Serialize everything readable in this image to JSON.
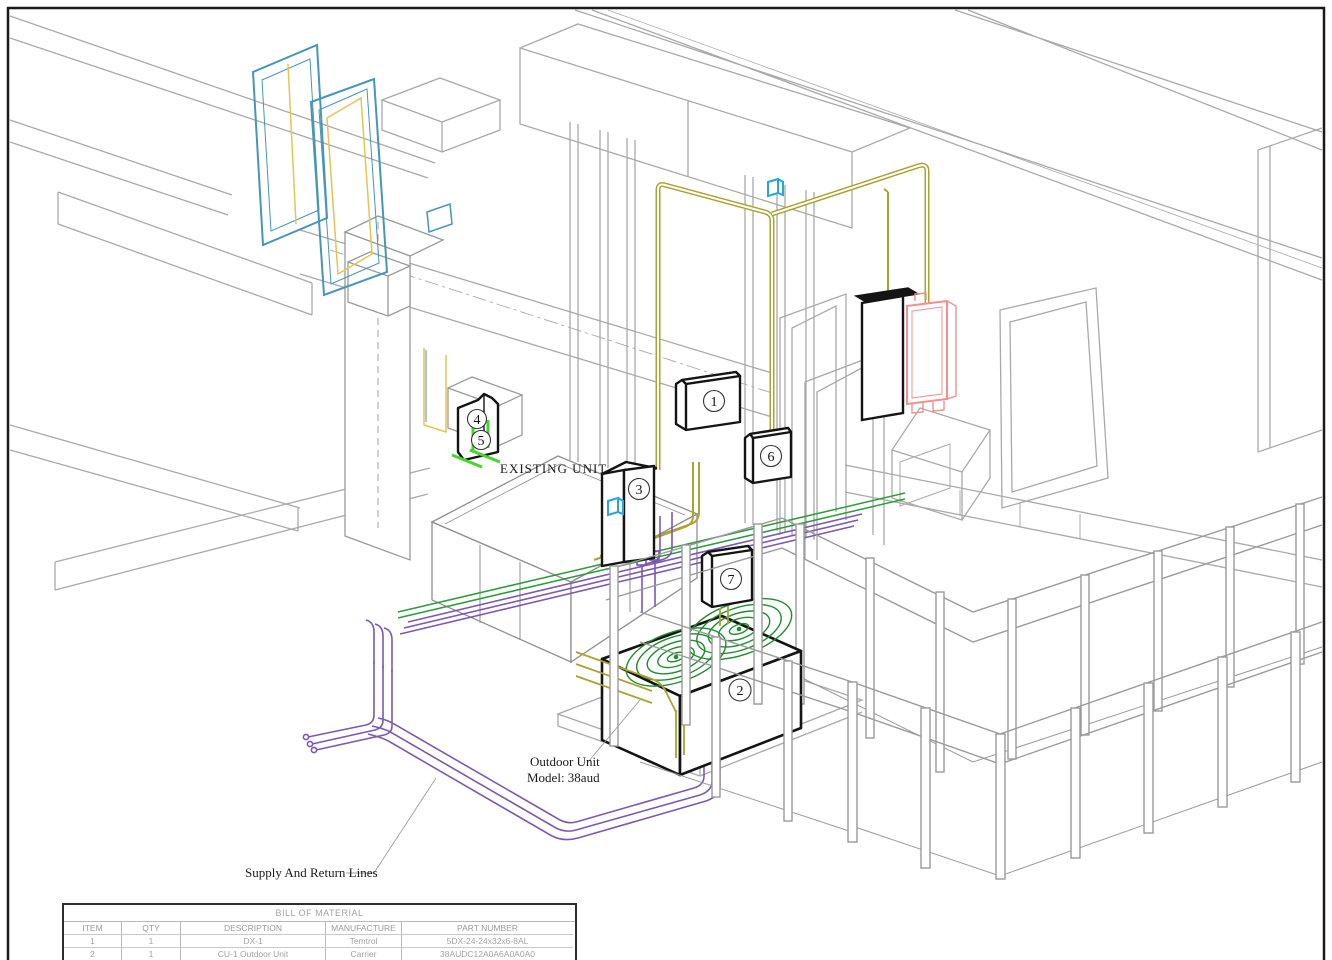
{
  "drawing": {
    "type": "isometric HVAC installation drawing",
    "annotations": {
      "existing_unit": "EXISTING UNIT",
      "outdoor_unit_line1": "Outdoor Unit",
      "outdoor_unit_line2": "Model: 38aud",
      "supply_return": "Supply And Return Lines"
    },
    "callouts": [
      {
        "number": "1"
      },
      {
        "number": "2"
      },
      {
        "number": "3"
      },
      {
        "number": "4"
      },
      {
        "number": "5"
      },
      {
        "number": "6"
      },
      {
        "number": "7"
      }
    ],
    "colors": {
      "structure_gray": "#a9a9a9",
      "heavy_black": "#141414",
      "teal_frame": "#4596b8",
      "yellow_frame": "#e6c44f",
      "conduit_olive": "#aaa32e",
      "pipe_purple": "#7e57b2",
      "pipe_green": "#2e9b3a",
      "mark_bright_green": "#44d62c",
      "fan_green": "#1f8c2f",
      "panel_red": "#f09090",
      "junction_cyan": "#25a6e0"
    }
  },
  "bom": {
    "title": "BILL OF MATERIAL",
    "columns": [
      "ITEM",
      "QTY",
      "DESCRIPTION",
      "MANUFACTURE",
      "PART NUMBER"
    ],
    "rows": [
      [
        "1",
        "1",
        "DX-1",
        "Temtrol",
        "5DX-24-24x32x6-8AL"
      ],
      [
        "2",
        "1",
        "CU-1 Outdoor Unit",
        "Carrier",
        "38AUDC12A0A6A0A0A0"
      ]
    ]
  }
}
